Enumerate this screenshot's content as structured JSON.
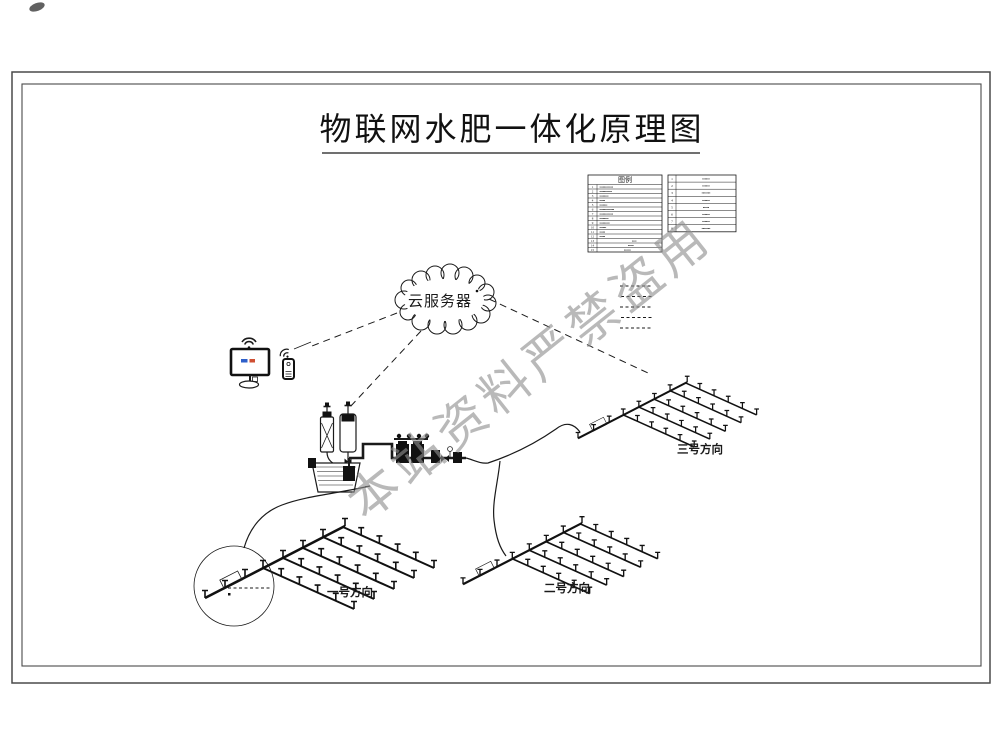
{
  "title": "物联网水肥一体化原理图",
  "watermark": "本站资料严禁盗用",
  "cloud_label": "云服务器",
  "legend": {
    "header": "图例",
    "table1_rows": [
      {
        "no": "1",
        "label": "▪▪▪▪▪▪▪▪▪▪▪▪"
      },
      {
        "no": "2",
        "label": "▪▪▪▪▪▪▪▪▪▪▪"
      },
      {
        "no": "3",
        "label": "▪▪▪▪▪▪▪▪"
      },
      {
        "no": "4",
        "label": "▪▪▪▪▪"
      },
      {
        "no": "5",
        "label": "▪▪▪▪▪▪▪"
      },
      {
        "no": "6",
        "label": "▪▪▪▪▪▪▪▪▪▪▪▪▪"
      },
      {
        "no": "7",
        "label": "▪▪▪▪▪▪▪▪▪▪▪▪"
      },
      {
        "no": "8",
        "label": "▪▪▪▪▪▪▪▪"
      },
      {
        "no": "9",
        "label": "▪▪▪▪▪▪▪▪▪"
      },
      {
        "no": "10",
        "label": "▪▪▪▪▪▪"
      },
      {
        "no": "11",
        "label": "▪▪▪▪▪"
      },
      {
        "no": "12",
        "label": "▪▪▪▪▪"
      },
      {
        "no": "13",
        "label": "▪▪▪▪"
      },
      {
        "no": "14",
        "label": "▪▪▪▪▪"
      },
      {
        "no": "15",
        "label": "▪▪▪▪▪▪"
      }
    ],
    "table2_rows": [
      {
        "no": "1",
        "label": "▪▪▪▪▪▪"
      },
      {
        "no": "2",
        "label": "▪▪▪▪▪▪"
      },
      {
        "no": "3",
        "label": "▪▪▪▪▪▪▪"
      },
      {
        "no": "4",
        "label": "▪▪▪▪▪▪"
      },
      {
        "no": "5",
        "label": "▪▪▪▪▪"
      },
      {
        "no": "6",
        "label": "▪▪▪▪▪▪"
      },
      {
        "no": "7",
        "label": "▪▪▪▪▪▪"
      },
      {
        "no": "8",
        "label": "▪▪▪▪▪▪▪"
      }
    ]
  },
  "fields": {
    "one": "一号方向",
    "two": "二号方向",
    "three": "三号方向"
  },
  "colors": {
    "line": "#1a1a1a",
    "watermark_gray": "#8f8f8f",
    "monitor_screen_blue": "#2e5fc9",
    "monitor_screen_red": "#cf4f33"
  }
}
